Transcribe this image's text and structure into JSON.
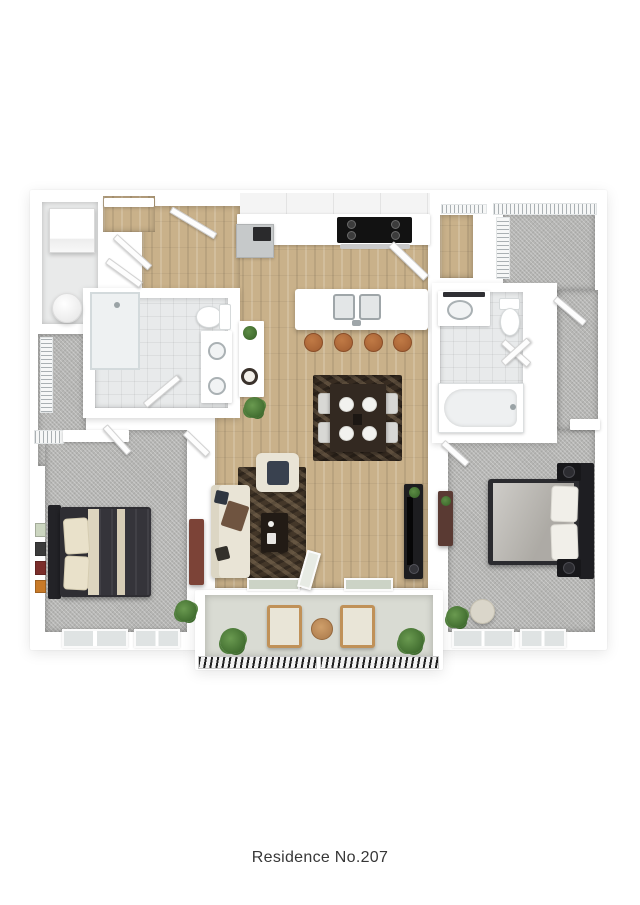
{
  "caption": {
    "text": "Residence No.207"
  },
  "plan": {
    "view": "3d-top-down-floorplan",
    "rooms": [
      "entry",
      "laundry",
      "entry-closet",
      "bathroom-1",
      "kitchen",
      "dining-area",
      "living-room",
      "bedroom-1",
      "bedroom-2",
      "bathroom-2",
      "walk-in-closet",
      "linen-closets",
      "hall-corridors",
      "balcony"
    ],
    "fixtures": [
      "washer",
      "water-heater",
      "shower",
      "double-vanity",
      "toilet",
      "kitchen-island-double-sink",
      "range",
      "refrigerator",
      "bar-stools-4",
      "dining-table-4-settings",
      "sofa",
      "armchair",
      "coffee-table",
      "tv-console",
      "queen-bed-dark",
      "queen-bed-gray",
      "nightstands",
      "bathtub",
      "balcony-chairs-2",
      "balcony-table",
      "potted-plants"
    ],
    "palette": {
      "wall": "#ffffff",
      "wood_floor": "#c9b18a",
      "carpet": "#b6b6b4",
      "tile": "#e8eaeb",
      "balcony_floor": "#d9dbd3",
      "rug_dark_brown": "#443729",
      "furniture_dark": "#2b2b2f",
      "cream_upholstery": "#e9e4d6",
      "stool_seat_orange": "#b0673a",
      "plant_green": "#4d7c38",
      "glass_pane": "#ccd3c6",
      "caption_text": "#373737"
    }
  }
}
